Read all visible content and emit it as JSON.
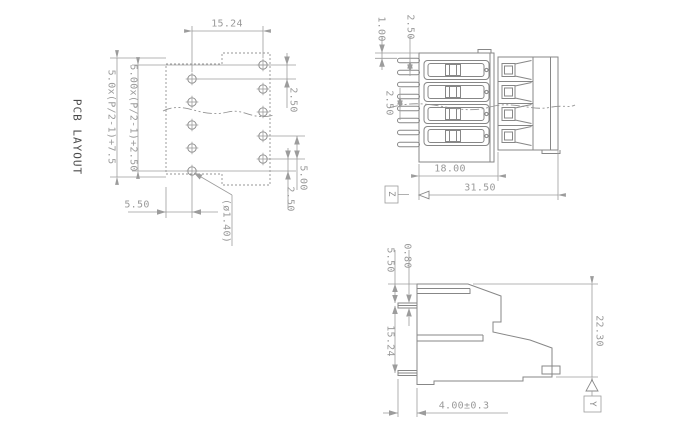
{
  "drawing": {
    "pcb_layout": {
      "title": "PCB LAYOUT",
      "dimensions": {
        "column_spacing": "15.24",
        "row_offset_top": "2.50",
        "hole_pitch": "5.00",
        "row_offset_bottom": "2.50",
        "edge_margin": "5.50",
        "hole_diameter": "(ø1.40)",
        "span_formula_inner": "5.00x(P/2-1)+2.50",
        "span_formula_outer": "5.0x(P/2-1)+7.5"
      }
    },
    "front_view": {
      "dimensions": {
        "pin_inset": "1.00",
        "pin_offset": "2.50",
        "pin_pitch": "2.50",
        "body_width": "18.00",
        "overall_width": "31.50"
      },
      "section_mark": "Z"
    },
    "side_view": {
      "dimensions": {
        "top_to_pin": "5.50",
        "pin_thickness": "0.80",
        "pin_spacing": "15.24",
        "overall_height": "22.30",
        "pin_length": "4.00±0.3"
      },
      "datum_mark": "Y"
    }
  }
}
